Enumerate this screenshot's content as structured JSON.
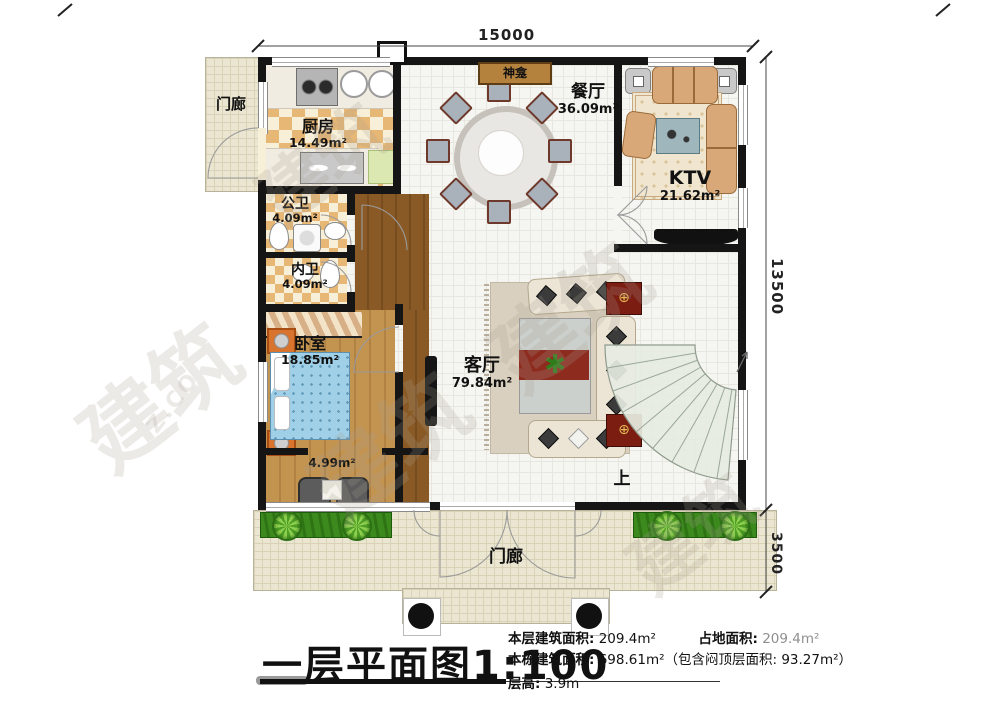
{
  "dimensions": {
    "top": "15000",
    "right_upper": "13500",
    "right_lower": "3500"
  },
  "rooms": {
    "porch_left": {
      "name": "门廊"
    },
    "kitchen": {
      "name": "厨房",
      "area": "14.49m²"
    },
    "shrine": {
      "name": "神龛"
    },
    "dining": {
      "name": "餐厅",
      "area": "36.09m²"
    },
    "ktv": {
      "name": "KTV",
      "area": "21.62m²"
    },
    "public_bath": {
      "name": "公卫",
      "area": "4.09m²"
    },
    "private_bath": {
      "name": "内卫",
      "area": "4.09m²"
    },
    "bedroom": {
      "name": "卧室",
      "area": "18.85m²"
    },
    "living": {
      "name": "客厅",
      "area": "79.84m²"
    },
    "balcony": {
      "area": "4.99m²"
    },
    "stair": {
      "up_label": "上"
    },
    "porch_bottom": {
      "name": "门廊"
    }
  },
  "title": {
    "text": "一层平面图",
    "scale": "1:100"
  },
  "stats": {
    "floor_area_label": "本层建筑面积:",
    "floor_area_value": "209.4m²",
    "land_area_label": "占地面积:",
    "land_area_value": "209.4m²",
    "total_area_label": "本栋建筑面积:",
    "total_area_value": "698.61m²（包含闷顶层面积: 93.27m²）",
    "height_label": "层高:",
    "height_value": "3.9m"
  },
  "watermark": {
    "text": "建筑",
    "text2": "Z.CO"
  }
}
